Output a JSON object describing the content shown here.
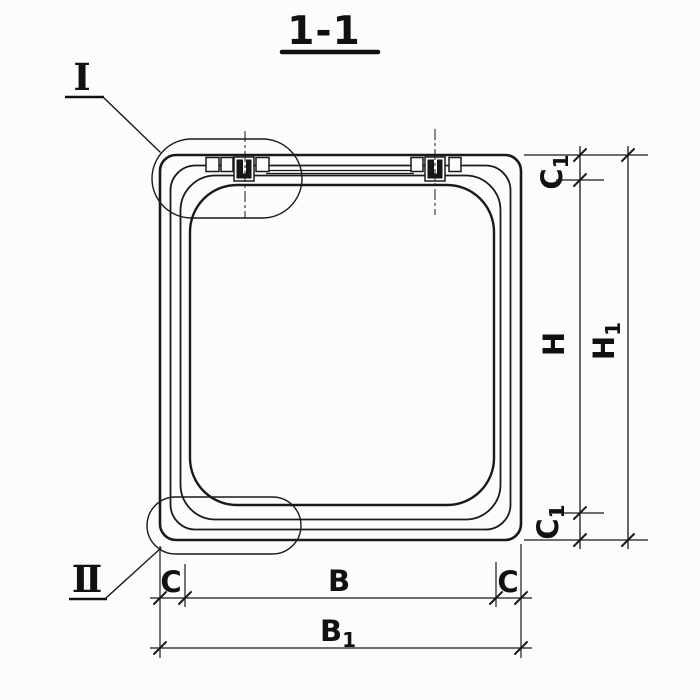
{
  "title": "1-1",
  "colors": {
    "ink": "#1a1a1a",
    "paper": "#fcfcfc"
  },
  "callouts": {
    "detail_1": {
      "label": "I"
    },
    "detail_2": {
      "label": "II"
    }
  },
  "dimensions": {
    "c1_top": {
      "main": "C",
      "sub": "1"
    },
    "h_inner": {
      "main": "H",
      "sub": ""
    },
    "h1_total": {
      "main": "H",
      "sub": "1"
    },
    "c1_bottom": {
      "main": "C",
      "sub": "1"
    },
    "c_left": {
      "main": "C",
      "sub": ""
    },
    "b_inner": {
      "main": "B",
      "sub": ""
    },
    "c_right": {
      "main": "C",
      "sub": ""
    },
    "b1_total": {
      "main": "B",
      "sub": "1"
    }
  }
}
